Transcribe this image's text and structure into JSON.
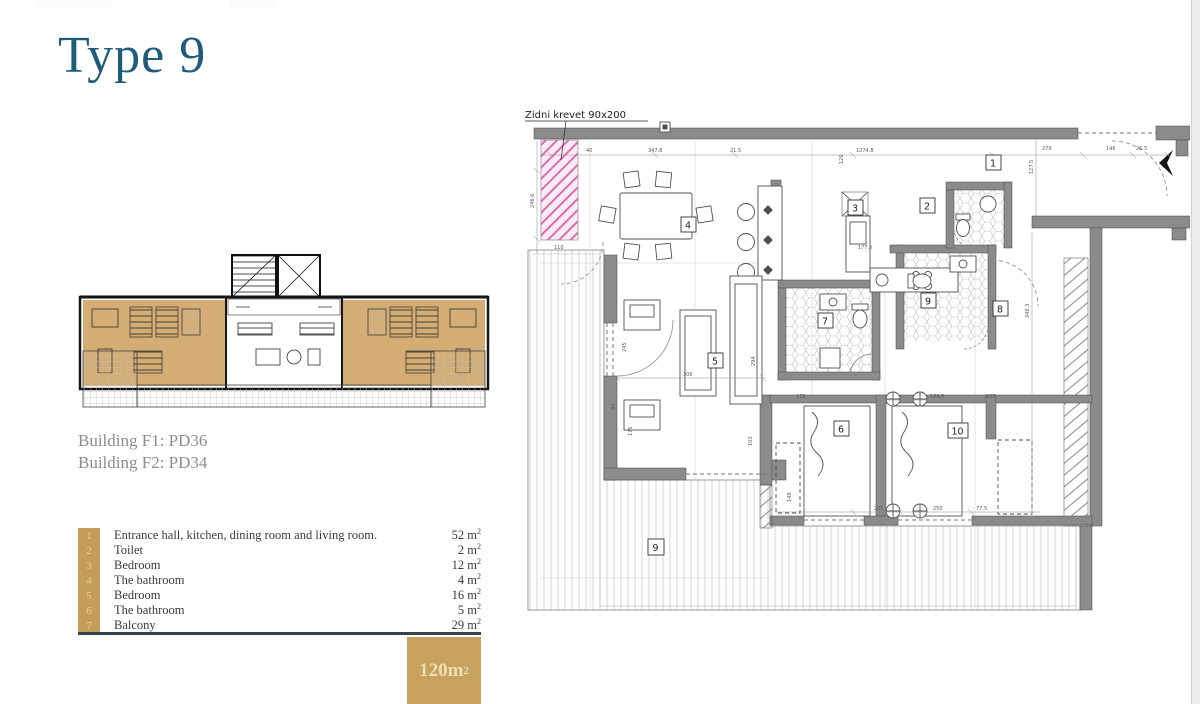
{
  "title": "Type 9",
  "buildings": {
    "line1": "Building F1: PD36",
    "line2": "Building F2: PD34"
  },
  "legend": {
    "unit_sup": "2",
    "rows": [
      {
        "num": "1",
        "label": "Entrance hall, kitchen, dining room and living room.",
        "area": "52 m"
      },
      {
        "num": "2",
        "label": "Toilet",
        "area": "2 m"
      },
      {
        "num": "3",
        "label": "Bedroom",
        "area": "12 m"
      },
      {
        "num": "4",
        "label": "The bathroom",
        "area": "4 m"
      },
      {
        "num": "5",
        "label": "Bedroom",
        "area": "16 m"
      },
      {
        "num": "6",
        "label": "The bathroom",
        "area": "5 m"
      },
      {
        "num": "7",
        "label": "Balcony",
        "area": "29 m"
      }
    ]
  },
  "area_badge": {
    "value": "120m",
    "sup": "2"
  },
  "plan": {
    "annotation": "Zidni krevet 90x200",
    "room_labels": [
      "1",
      "2",
      "3",
      "4",
      "5",
      "6",
      "7",
      "8",
      "9",
      "10",
      "9"
    ],
    "dims": [
      "40",
      "347.8",
      "21.5",
      "1274.8",
      "279",
      "146",
      "26.5",
      "246.6",
      "110",
      "127.5",
      "126",
      "177.5",
      "306",
      "245",
      "94",
      "175",
      "294",
      "103",
      "122",
      "169.5",
      "108",
      "348.3",
      "205",
      "250",
      "77.5",
      "148"
    ]
  }
}
